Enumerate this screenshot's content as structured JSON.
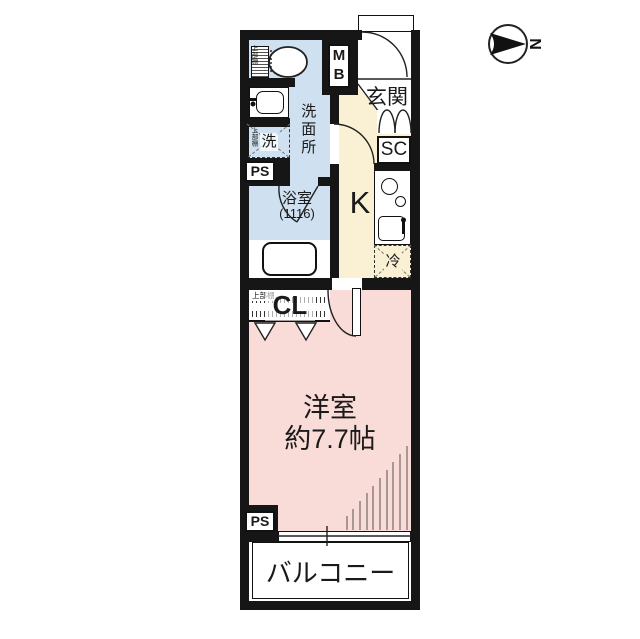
{
  "compass": {
    "north_label": "N"
  },
  "plan": {
    "meter_box": "M\nB",
    "entrance": "玄関",
    "shoe_closet": "SC",
    "washroom": "洗面所",
    "washer": "洗",
    "washer_shelf": "上部棚",
    "toilet_shelf": "上部棚",
    "pipe_space_top": "PS",
    "bathroom": "浴室",
    "bathroom_size": "(1116)",
    "kitchen": "K",
    "fridge": "冷",
    "closet": "CL",
    "closet_shelf": "上部棚",
    "main_room": "洋室",
    "main_room_size": "約7.7帖",
    "pipe_space_bottom": "PS",
    "balcony": "バルコニー"
  },
  "colors": {
    "wall": "#161616",
    "wet": "#cfe1f1",
    "hall": "#faf0d3",
    "room": "#f9dcd7"
  }
}
